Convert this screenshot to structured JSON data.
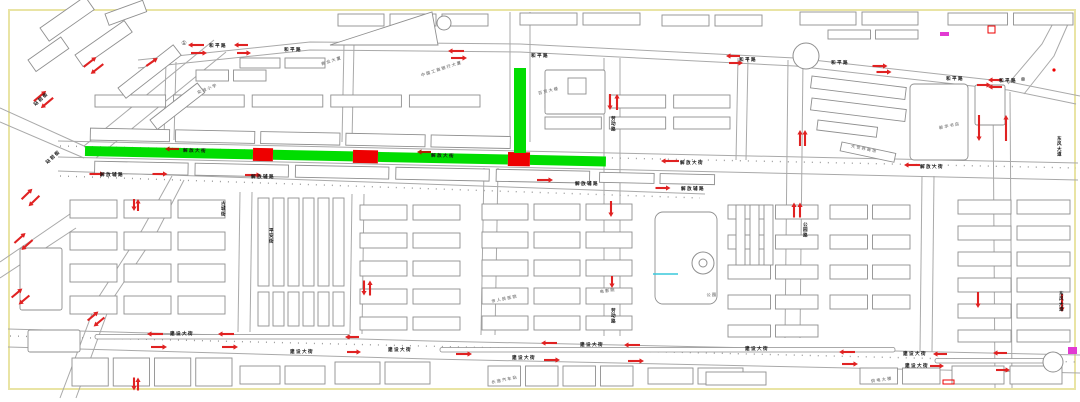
{
  "title": "城市道路单行线规划图",
  "colors": {
    "background": "#ffffff",
    "frame": "#e9e4a4",
    "road": "#a9a9a9",
    "building": "#8f8f8f",
    "green_segment": "#00dd00",
    "red_block": "#ee0000",
    "arrow": "#e02222",
    "band_arrow": "#b22200",
    "label": "#141414",
    "poi": "#8a8a8a",
    "magenta": "#e23ad2",
    "cyan": "#39c8dc"
  },
  "frame": {
    "x": 9,
    "y": 10,
    "w": 1066,
    "h": 379
  },
  "band": {
    "rotate": 1.15,
    "cx": 85,
    "cy": 151
  },
  "green_segments": [
    [
      85,
      146,
      168,
      10
    ],
    [
      273,
      146,
      80,
      10
    ],
    [
      378,
      146,
      130,
      10
    ],
    [
      530,
      146,
      76,
      10
    ]
  ],
  "green_vertical": [
    514,
    68,
    12,
    85
  ],
  "red_blocks": [
    [
      253,
      144.5,
      20,
      13
    ],
    [
      353,
      144.5,
      25,
      13
    ],
    [
      508,
      143.5,
      22,
      14
    ]
  ],
  "band_rows": [
    [
      90,
      128,
      420,
      12,
      5,
      6
    ],
    [
      95,
      161,
      495,
      12,
      5,
      7
    ],
    [
      600,
      162,
      115,
      10,
      2,
      6
    ]
  ],
  "roads": [
    [
      [
        138,
        60
      ],
      [
        310,
        42
      ],
      [
        520,
        44
      ],
      [
        795,
        58
      ],
      [
        1010,
        82
      ],
      [
        1080,
        96
      ]
    ],
    [
      [
        138,
        68
      ],
      [
        310,
        50
      ],
      [
        520,
        52
      ],
      [
        795,
        66
      ],
      [
        1008,
        90
      ],
      [
        1076,
        104
      ]
    ],
    [
      [
        1008,
        84
      ],
      [
        1042,
        44
      ],
      [
        1058,
        14
      ]
    ],
    [
      [
        1024,
        94
      ],
      [
        1054,
        56
      ],
      [
        1068,
        24
      ]
    ],
    [
      [
        58,
        141
      ],
      [
        1078,
        163
      ]
    ],
    [
      [
        58,
        157
      ],
      [
        1078,
        180
      ]
    ],
    [
      [
        58,
        171
      ],
      [
        705,
        194
      ]
    ],
    [
      [
        8,
        329
      ],
      [
        430,
        341
      ],
      [
        1080,
        355
      ]
    ],
    [
      [
        8,
        347
      ],
      [
        430,
        359
      ],
      [
        1080,
        373
      ]
    ],
    [
      [
        993,
        92
      ],
      [
        995,
        388
      ]
    ],
    [
      [
        1010,
        92
      ],
      [
        1012,
        388
      ]
    ],
    [
      [
        510,
        12
      ],
      [
        510,
        142
      ]
    ],
    [
      [
        530,
        12
      ],
      [
        530,
        142
      ]
    ],
    [
      [
        484,
        168
      ],
      [
        481,
        335
      ]
    ],
    [
      [
        498,
        168
      ],
      [
        495,
        335
      ]
    ],
    [
      [
        604,
        58
      ],
      [
        604,
        336
      ]
    ],
    [
      [
        620,
        58
      ],
      [
        620,
        336
      ]
    ],
    [
      [
        788,
        60
      ],
      [
        785,
        338
      ]
    ],
    [
      [
        803,
        60
      ],
      [
        800,
        338
      ]
    ],
    [
      [
        240,
        192
      ],
      [
        238,
        332
      ]
    ],
    [
      [
        252,
        192
      ],
      [
        250,
        332
      ]
    ],
    [
      [
        352,
        194
      ],
      [
        350,
        334
      ]
    ],
    [
      [
        364,
        194
      ],
      [
        362,
        334
      ]
    ],
    [
      [
        922,
        176
      ],
      [
        920,
        352
      ]
    ],
    [
      [
        934,
        176
      ],
      [
        932,
        352
      ]
    ],
    [
      [
        166,
        62
      ],
      [
        164,
        140
      ]
    ],
    [
      [
        176,
        62
      ],
      [
        174,
        140
      ]
    ],
    [
      [
        344,
        44
      ],
      [
        342,
        142
      ]
    ],
    [
      [
        354,
        44
      ],
      [
        352,
        142
      ]
    ],
    [
      [
        738,
        58
      ],
      [
        736,
        160
      ]
    ],
    [
      [
        748,
        58
      ],
      [
        746,
        160
      ]
    ],
    [
      [
        0,
        108
      ],
      [
        84,
        146
      ]
    ],
    [
      [
        0,
        122
      ],
      [
        84,
        158
      ]
    ],
    [
      [
        84,
        146
      ],
      [
        214,
        40
      ]
    ],
    [
      [
        96,
        158
      ],
      [
        226,
        52
      ]
    ],
    [
      [
        60,
        398
      ],
      [
        98,
        298
      ],
      [
        142,
        230
      ],
      [
        172,
        176
      ]
    ],
    [
      [
        76,
        398
      ],
      [
        112,
        300
      ],
      [
        156,
        234
      ],
      [
        184,
        180
      ]
    ],
    [
      [
        0,
        262
      ],
      [
        70,
        214
      ]
    ],
    [
      [
        0,
        278
      ],
      [
        76,
        228
      ]
    ]
  ],
  "tree_lines": [
    [
      [
        60,
        146
      ],
      [
        1076,
        168
      ]
    ],
    [
      [
        10,
        336
      ],
      [
        1078,
        362
      ]
    ],
    [
      [
        60,
        176
      ],
      [
        700,
        198
      ]
    ]
  ],
  "medians": [
    [
      95,
      334.5,
      255,
      4.5
    ],
    [
      440,
      347.5,
      455,
      4.5
    ],
    [
      935,
      358.5,
      125,
      4.5
    ]
  ],
  "building_rows": [
    [
      95,
      95,
      385,
      12,
      5,
      8
    ],
    [
      545,
      95,
      185,
      13,
      3,
      8
    ],
    [
      545,
      117,
      185,
      12,
      3,
      8
    ],
    [
      338,
      14,
      150,
      12,
      3,
      6
    ],
    [
      520,
      13,
      120,
      12,
      2,
      6
    ],
    [
      662,
      15,
      100,
      11,
      2,
      6
    ],
    [
      800,
      12,
      118,
      13,
      2,
      6
    ],
    [
      948,
      13,
      125,
      12,
      2,
      6
    ],
    [
      828,
      30,
      90,
      9,
      2,
      5
    ],
    [
      240,
      58,
      85,
      10,
      2,
      5
    ],
    [
      196,
      70,
      70,
      11,
      2,
      5
    ],
    [
      70,
      200,
      155,
      18,
      3,
      7
    ],
    [
      70,
      232,
      155,
      18,
      3,
      7
    ],
    [
      70,
      264,
      155,
      18,
      3,
      7
    ],
    [
      70,
      296,
      155,
      18,
      3,
      7
    ],
    [
      360,
      205,
      100,
      15,
      2,
      6
    ],
    [
      360,
      233,
      100,
      15,
      2,
      6
    ],
    [
      360,
      261,
      100,
      15,
      2,
      6
    ],
    [
      360,
      289,
      100,
      15,
      2,
      6
    ],
    [
      360,
      317,
      100,
      13,
      2,
      6
    ],
    [
      482,
      204,
      150,
      16,
      3,
      6
    ],
    [
      482,
      232,
      150,
      16,
      3,
      6
    ],
    [
      482,
      260,
      150,
      16,
      3,
      6
    ],
    [
      482,
      288,
      150,
      16,
      3,
      6
    ],
    [
      482,
      316,
      150,
      14,
      3,
      6
    ],
    [
      728,
      205,
      90,
      14,
      2,
      5
    ],
    [
      728,
      235,
      90,
      14,
      2,
      5
    ],
    [
      728,
      265,
      90,
      14,
      2,
      5
    ],
    [
      728,
      295,
      90,
      14,
      2,
      5
    ],
    [
      728,
      325,
      90,
      12,
      2,
      5
    ],
    [
      830,
      205,
      80,
      14,
      2,
      5
    ],
    [
      830,
      235,
      80,
      14,
      2,
      5
    ],
    [
      830,
      265,
      80,
      14,
      2,
      5
    ],
    [
      830,
      295,
      80,
      14,
      2,
      5
    ],
    [
      958,
      200,
      112,
      14,
      2,
      6
    ],
    [
      958,
      226,
      112,
      14,
      2,
      6
    ],
    [
      958,
      252,
      112,
      14,
      2,
      6
    ],
    [
      958,
      278,
      112,
      14,
      2,
      6
    ],
    [
      958,
      304,
      112,
      14,
      2,
      6
    ],
    [
      958,
      330,
      112,
      12,
      2,
      6
    ],
    [
      72,
      358,
      160,
      28,
      4,
      5
    ],
    [
      240,
      366,
      85,
      18,
      2,
      5
    ],
    [
      335,
      362,
      95,
      22,
      2,
      5
    ],
    [
      488,
      366,
      145,
      20,
      4,
      5
    ],
    [
      648,
      368,
      95,
      16,
      2,
      5
    ],
    [
      706,
      372,
      60,
      13,
      1,
      0
    ],
    [
      860,
      368,
      80,
      16,
      2,
      5
    ],
    [
      952,
      366,
      110,
      18,
      2,
      6
    ]
  ],
  "building_vcols": [
    [
      258,
      198,
      11,
      88,
      6,
      4
    ],
    [
      258,
      292,
      11,
      34,
      6,
      4
    ],
    [
      736,
      205,
      9,
      60,
      3,
      5
    ]
  ],
  "building_rot": [
    [
      40,
      28,
      55,
      16,
      -35
    ],
    [
      75,
      55,
      60,
      14,
      -35
    ],
    [
      118,
      88,
      70,
      13,
      -38
    ],
    [
      150,
      120,
      60,
      12,
      -38
    ],
    [
      28,
      60,
      40,
      14,
      -35
    ],
    [
      105,
      14,
      40,
      12,
      -20
    ],
    [
      812,
      76,
      95,
      12,
      7
    ],
    [
      812,
      98,
      95,
      12,
      7
    ],
    [
      818,
      120,
      60,
      10,
      7
    ],
    [
      842,
      142,
      55,
      9,
      12
    ]
  ],
  "building_outlines": [
    [
      910,
      84,
      58,
      76,
      4
    ],
    [
      655,
      212,
      62,
      92,
      8
    ],
    [
      545,
      70,
      60,
      44,
      2
    ],
    [
      568,
      78,
      18,
      16,
      0
    ],
    [
      20,
      248,
      42,
      62,
      2
    ],
    [
      28,
      330,
      52,
      22,
      2
    ],
    [
      975,
      85,
      30,
      40,
      2
    ]
  ],
  "polygons": [
    [
      [
        330,
        45
      ],
      [
        432,
        12
      ],
      [
        438,
        45
      ]
    ],
    [
      [
        1053,
        355
      ],
      [
        1060,
        362
      ],
      [
        1053,
        369
      ],
      [
        1046,
        362
      ]
    ]
  ],
  "circles": [
    [
      444,
      23,
      7
    ],
    [
      806,
      56,
      13
    ],
    [
      703,
      263,
      11
    ],
    [
      703,
      263,
      4
    ],
    [
      1053,
      362,
      10
    ]
  ],
  "arrows": [
    [
      196,
      45,
      180,
      16
    ],
    [
      199,
      53,
      0,
      16
    ],
    [
      241,
      45,
      180,
      14
    ],
    [
      244,
      53,
      0,
      14
    ],
    [
      456,
      51,
      180,
      16
    ],
    [
      459,
      58,
      0,
      16
    ],
    [
      733,
      56,
      180,
      14
    ],
    [
      736,
      63,
      0,
      14
    ],
    [
      880,
      66,
      0,
      15
    ],
    [
      884,
      72,
      0,
      15
    ],
    [
      995,
      80,
      180,
      14
    ],
    [
      995,
      87,
      180,
      14
    ],
    [
      90,
      62,
      -38,
      16
    ],
    [
      97,
      69,
      142,
      16
    ],
    [
      40,
      96,
      -40,
      16
    ],
    [
      47,
      103,
      140,
      16
    ],
    [
      152,
      62,
      -35,
      14
    ],
    [
      27,
      194,
      -44,
      15
    ],
    [
      34,
      201,
      136,
      15
    ],
    [
      20,
      238,
      -42,
      15
    ],
    [
      27,
      245,
      138,
      15
    ],
    [
      17,
      293,
      -40,
      14
    ],
    [
      24,
      300,
      140,
      14
    ],
    [
      93,
      316,
      -40,
      14
    ],
    [
      99,
      322,
      140,
      14
    ],
    [
      610,
      102,
      90,
      16
    ],
    [
      617,
      102,
      -90,
      16
    ],
    [
      800,
      138,
      -90,
      16
    ],
    [
      805,
      138,
      -90,
      16
    ],
    [
      134,
      205,
      90,
      12
    ],
    [
      138,
      205,
      -90,
      12
    ],
    [
      364,
      288,
      90,
      15
    ],
    [
      370,
      288,
      -90,
      15
    ],
    [
      611,
      209,
      90,
      16
    ],
    [
      612,
      282,
      90,
      12
    ],
    [
      794,
      210,
      -90,
      15
    ],
    [
      800,
      210,
      -90,
      15
    ],
    [
      134,
      384,
      90,
      13
    ],
    [
      138,
      384,
      -90,
      13
    ],
    [
      979,
      128,
      90,
      26
    ],
    [
      1006,
      128,
      -90,
      26
    ],
    [
      978,
      300,
      90,
      16
    ],
    [
      1062,
      303,
      90,
      18
    ],
    [
      984,
      85,
      0,
      14
    ],
    [
      670,
      161,
      180,
      18
    ],
    [
      912,
      165,
      180,
      16
    ],
    [
      97,
      174,
      0,
      15
    ],
    [
      160,
      174,
      0,
      15
    ],
    [
      253,
      175,
      0,
      16
    ],
    [
      545,
      180,
      0,
      16
    ],
    [
      663,
      188,
      0,
      15
    ],
    [
      172,
      149,
      180,
      14,
      "band"
    ],
    [
      424,
      152,
      180,
      14,
      "band"
    ],
    [
      155,
      334,
      180,
      16
    ],
    [
      159,
      347,
      0,
      16
    ],
    [
      226,
      334,
      180,
      16
    ],
    [
      230,
      347,
      0,
      16
    ],
    [
      352,
      337,
      180,
      14
    ],
    [
      354,
      352,
      0,
      14
    ],
    [
      464,
      354,
      0,
      16
    ],
    [
      549,
      343,
      180,
      16
    ],
    [
      552,
      360,
      0,
      16
    ],
    [
      632,
      345,
      180,
      16
    ],
    [
      636,
      361,
      0,
      16
    ],
    [
      847,
      352,
      180,
      16
    ],
    [
      850,
      364,
      0,
      16
    ],
    [
      940,
      354,
      180,
      14
    ],
    [
      937,
      366,
      0,
      14
    ],
    [
      1000,
      353,
      180,
      14
    ],
    [
      1003,
      370,
      0,
      14
    ]
  ],
  "labels": [
    [
      "和平路",
      218,
      47
    ],
    [
      "和平路",
      293,
      51
    ],
    [
      "和平路",
      540,
      57
    ],
    [
      "和平路",
      748,
      61
    ],
    [
      "和平路",
      840,
      64
    ],
    [
      "和平路",
      955,
      80
    ],
    [
      "和平路",
      1008,
      82
    ],
    [
      "解放大街",
      195,
      152,
      1
    ],
    [
      "解放大街",
      443,
      157,
      1
    ],
    [
      "解放大街",
      692,
      164
    ],
    [
      "解放大街",
      932,
      168
    ],
    [
      "解放辅路",
      112,
      176
    ],
    [
      "解放辅路",
      263,
      178
    ],
    [
      "解放辅路",
      587,
      185
    ],
    [
      "解放辅路",
      693,
      190
    ],
    [
      "建设大街",
      182,
      335
    ],
    [
      "建设大街",
      302,
      353
    ],
    [
      "建设大街",
      400,
      351
    ],
    [
      "建设大街",
      524,
      359
    ],
    [
      "建设大街",
      592,
      346
    ],
    [
      "建设大街",
      757,
      350
    ],
    [
      "建设大街",
      915,
      355
    ],
    [
      "建设大街",
      917,
      367
    ],
    [
      "古城街",
      224,
      205,
      0,
      1
    ],
    [
      "平安街",
      272,
      232,
      0,
      1
    ],
    [
      "劳动路",
      614,
      120,
      0,
      1
    ],
    [
      "劳动路",
      614,
      312,
      0,
      1
    ],
    [
      "公园路",
      806,
      226,
      0,
      1
    ],
    [
      "东风大道",
      1060,
      140,
      0,
      1
    ],
    [
      "东风大道",
      1062,
      295,
      0,
      1
    ],
    [
      "站前街",
      54,
      158,
      -42
    ],
    [
      "站前街",
      42,
      100,
      -42
    ],
    [
      "商业大厦",
      332,
      62,
      -18,
      0,
      "#8a8a8a",
      4
    ],
    [
      "中国工商银行大厦",
      442,
      70,
      -18,
      0,
      "#8a8a8a",
      4
    ],
    [
      "百货大楼",
      549,
      92,
      -14,
      0,
      "#8a8a8a",
      4
    ],
    [
      "大世界商场",
      864,
      150,
      12,
      0,
      "#8a8a8a",
      4
    ],
    [
      "新华书店",
      950,
      127,
      -12,
      0,
      "#8a8a8a",
      4
    ],
    [
      "实验小学",
      208,
      90,
      -22,
      0,
      "#8a8a8a",
      4
    ],
    [
      "市人民医院",
      505,
      300,
      -12,
      0,
      "#8a8a8a",
      4
    ],
    [
      "电影院",
      608,
      292,
      -8,
      0,
      "#8a8a8a",
      4
    ],
    [
      "公园",
      712,
      296,
      0,
      0,
      "#8a8a8a",
      4
    ],
    [
      "长途汽车站",
      505,
      381,
      -12,
      0,
      "#8a8a8a",
      4
    ],
    [
      "供电大楼",
      882,
      381,
      -8,
      0,
      "#8a8a8a",
      4
    ]
  ],
  "symbols": [
    {
      "t": "①",
      "x": 184,
      "y": 45
    },
    {
      "t": "⊗",
      "x": 1023,
      "y": 81
    }
  ],
  "marks": {
    "magenta_rects": [
      [
        940,
        32,
        9,
        4
      ],
      [
        1068,
        347,
        9,
        7
      ]
    ],
    "red_outline_rects": [
      [
        988,
        26,
        7,
        7
      ],
      [
        943,
        380,
        11,
        4
      ]
    ],
    "red_dots": [
      [
        1054,
        70,
        1.6
      ]
    ],
    "cyan_lines": [
      [
        [
          653,
          274
        ],
        [
          678,
          274
        ]
      ]
    ]
  }
}
